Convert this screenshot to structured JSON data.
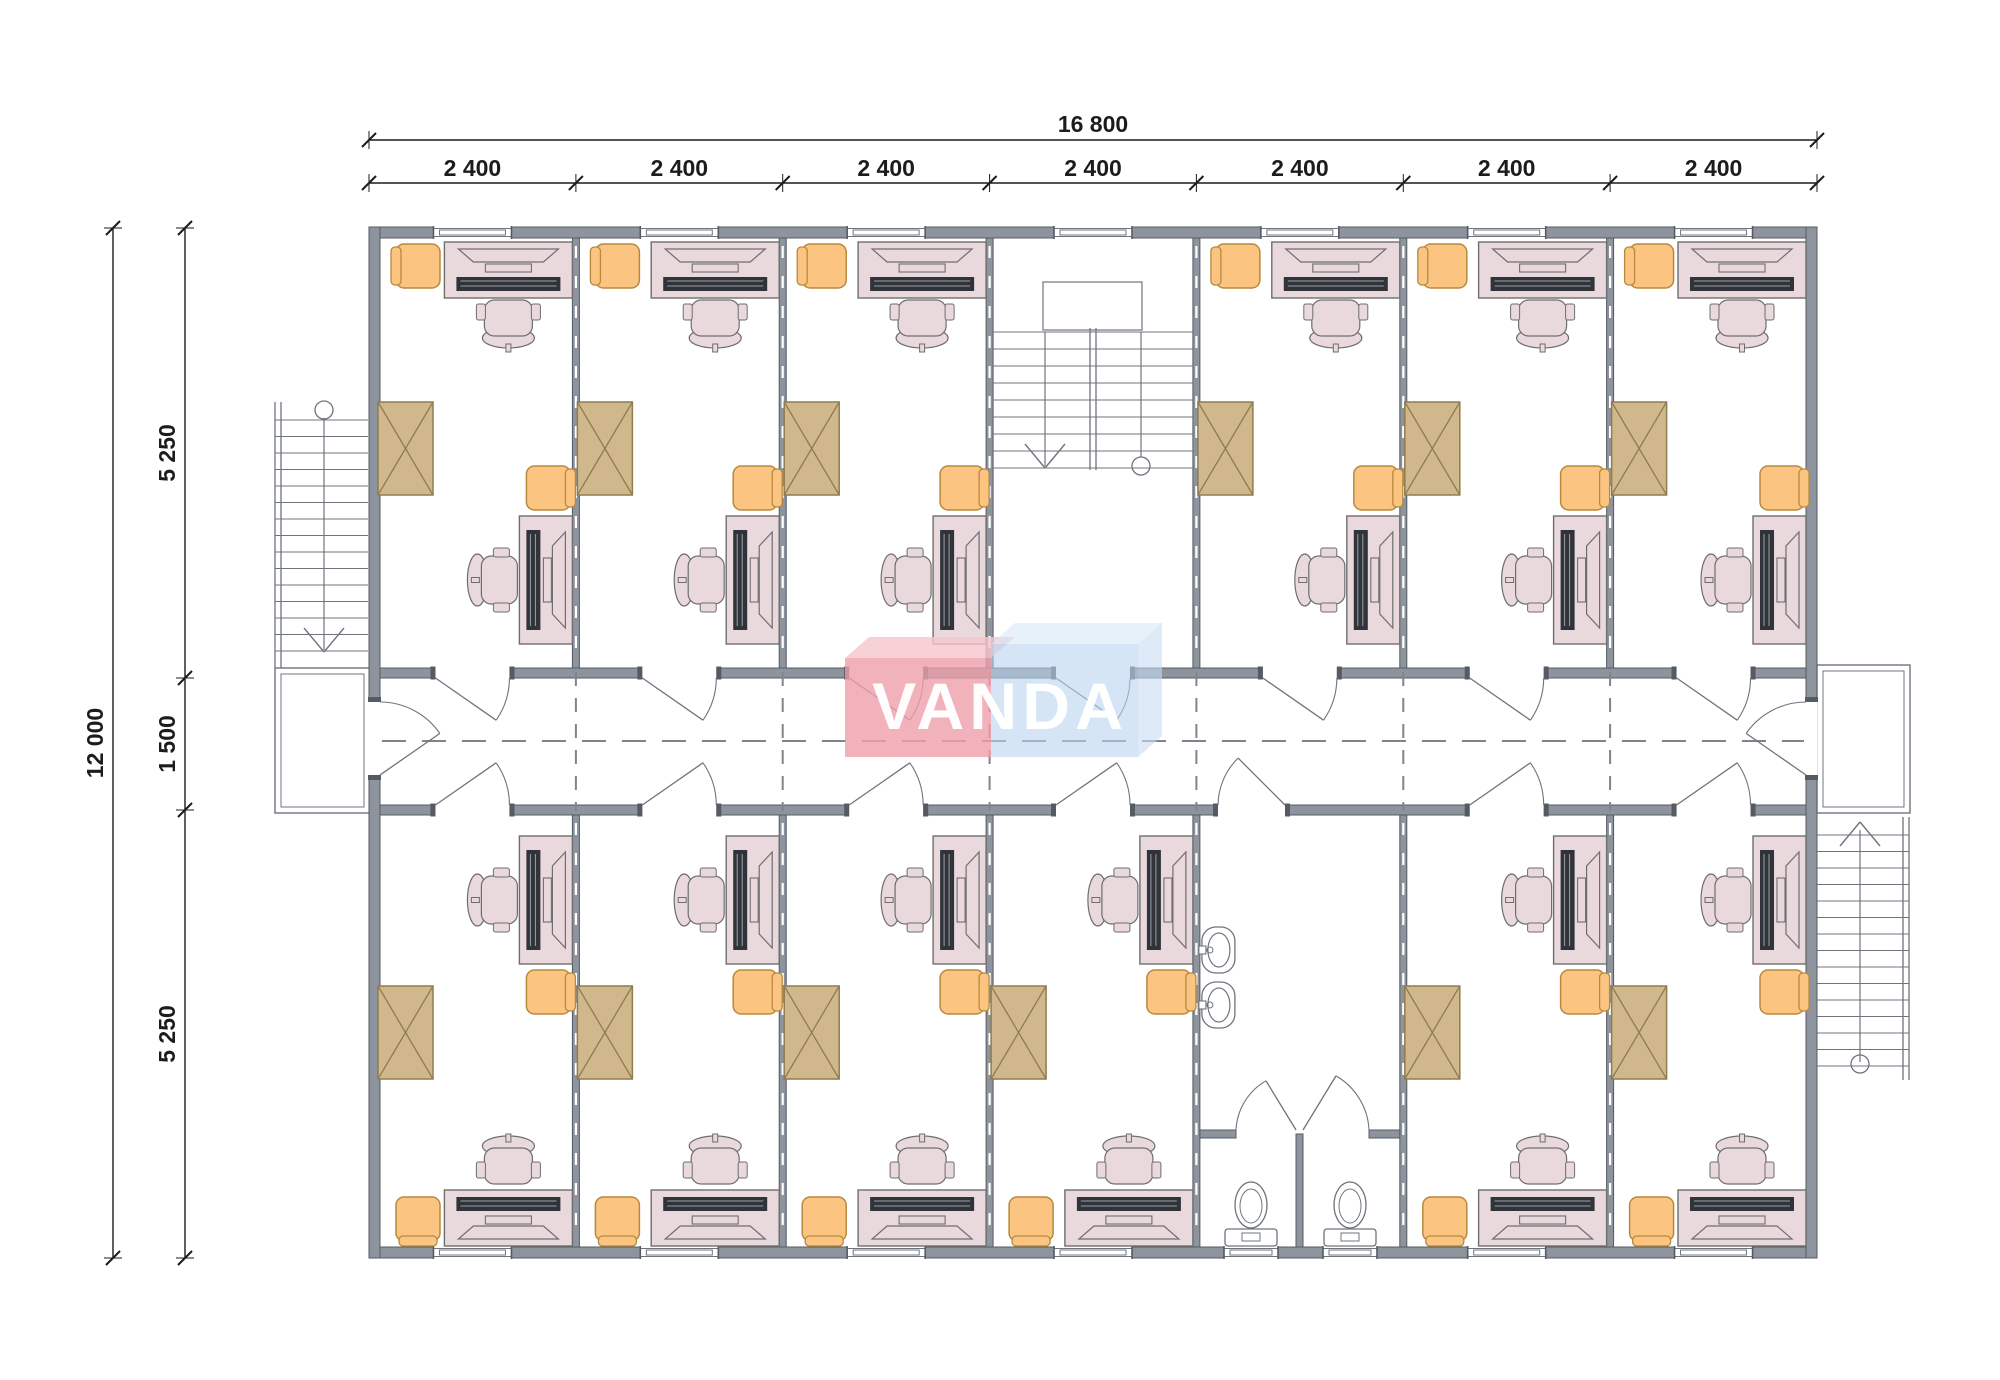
{
  "logo": {
    "text": "VANDA",
    "pink": "#ef9fab",
    "pink_lid": "#f6c5cc",
    "blue": "#b9d4ee",
    "blue_lid": "#d6e7f7",
    "blue_side": "#c8dcf3",
    "text_color": "#ffffff",
    "pink_opacity": 0.8,
    "blue_opacity": 0.6,
    "block_pink": [
      845,
      658,
      146,
      99
    ],
    "block_blue": [
      991,
      644,
      147,
      113
    ],
    "lid_dx": 24,
    "lid_dy": 21,
    "font_size": 66,
    "baseline": 729,
    "x_start": 872,
    "text_length": 256
  },
  "colors": {
    "wall_fill": "#8d949d",
    "wall_stroke": "#565b63",
    "thin": "#6f747c",
    "dash": "#80858d",
    "dim": "#1c1c1c",
    "desk_fill": "#e9d8dc",
    "desk_stroke": "#6e6e6e",
    "orange_fill": "#fbc481",
    "orange_stroke": "#b7893e",
    "tan_fill": "#d0b88c",
    "tan_stroke": "#8f7c4f",
    "device_dark": "#30343a",
    "white": "#ffffff"
  },
  "dimensions": {
    "top_total": {
      "label": "16 800",
      "y": 140,
      "label_y": 132,
      "x1": 369,
      "x2": 1817
    },
    "top_segments": {
      "y": 183,
      "label_y": 176,
      "labels": [
        "2 400",
        "2 400",
        "2 400",
        "2 400",
        "2 400",
        "2 400",
        "2 400"
      ]
    },
    "left_total": {
      "label": "12 000",
      "x": 113,
      "y1": 228,
      "y2": 1258,
      "label_x": 103
    },
    "left_segments": {
      "x": 185,
      "label_x": 175,
      "ticks": [
        228,
        678,
        810,
        1258
      ],
      "labels": [
        "5 250",
        "1 500",
        "5 250"
      ]
    },
    "font_size": 23
  },
  "building": {
    "x": 369,
    "y": 227,
    "w": 1448,
    "h": 1031,
    "ext_wall": 11,
    "int_wall": 7,
    "columns": [
      369,
      575.9,
      782.7,
      989.6,
      1196.4,
      1403.3,
      1610.1,
      1817
    ],
    "corridor": {
      "wall_y1": 668,
      "wall_y2": 805,
      "wall_t": 10,
      "dash_y": 741
    },
    "top_room_y": 238,
    "bottom_room_y2": 1247
  },
  "layout": {
    "top_offices": [
      0,
      1,
      2,
      4,
      5,
      6
    ],
    "bottom_offices": [
      0,
      1,
      2,
      3,
      5,
      6
    ],
    "stair_hall_col": 3,
    "bathroom_col": 4,
    "window_w": 78,
    "door_w": 74
  },
  "stair_hall": {
    "landing": [
      1043,
      282,
      99,
      48
    ],
    "tread_y1": 332,
    "tread_y2": 468,
    "tread_step": 17,
    "divider_x": [
      1090,
      1096
    ],
    "arrow_x": 1045,
    "circle_x": 1141,
    "circle_y": 466,
    "circle_r": 9
  },
  "bathroom": {
    "sink_cy": [
      950,
      1005
    ],
    "stall_divider": [
      1296,
      1134,
      7,
      113
    ],
    "front_wall_y": 1130,
    "front_wall_t": 8,
    "stall_doors": [
      {
        "x1": 1236,
        "x2": 1296,
        "hinge": "right"
      },
      {
        "x1": 1303,
        "x2": 1369,
        "hinge": "left"
      }
    ],
    "toilet_cx": [
      1251,
      1350
    ],
    "window_cx": [
      1251,
      1350
    ],
    "window_w": 54,
    "corridor_door": {
      "x1": 1218,
      "x2": 1285
    }
  },
  "exterior_stairs": {
    "left": {
      "x1": 275,
      "x2": 368,
      "y1": 402,
      "y2": 668,
      "rail_x": [
        275,
        281
      ],
      "circle": [
        324,
        410
      ],
      "arrow_apex": [
        324,
        652
      ],
      "landing": [
        275,
        668,
        95,
        145
      ]
    },
    "right": {
      "x1": 1817,
      "x2": 1909,
      "y1": 817,
      "y2": 1080,
      "rail_x": [
        1903,
        1909
      ],
      "circle": [
        1860,
        1064
      ],
      "arrow_apex": [
        1860,
        822
      ],
      "landing": [
        1817,
        665,
        93,
        148
      ]
    }
  },
  "corridor_end_doors": {
    "y1": 702,
    "y2": 775
  }
}
